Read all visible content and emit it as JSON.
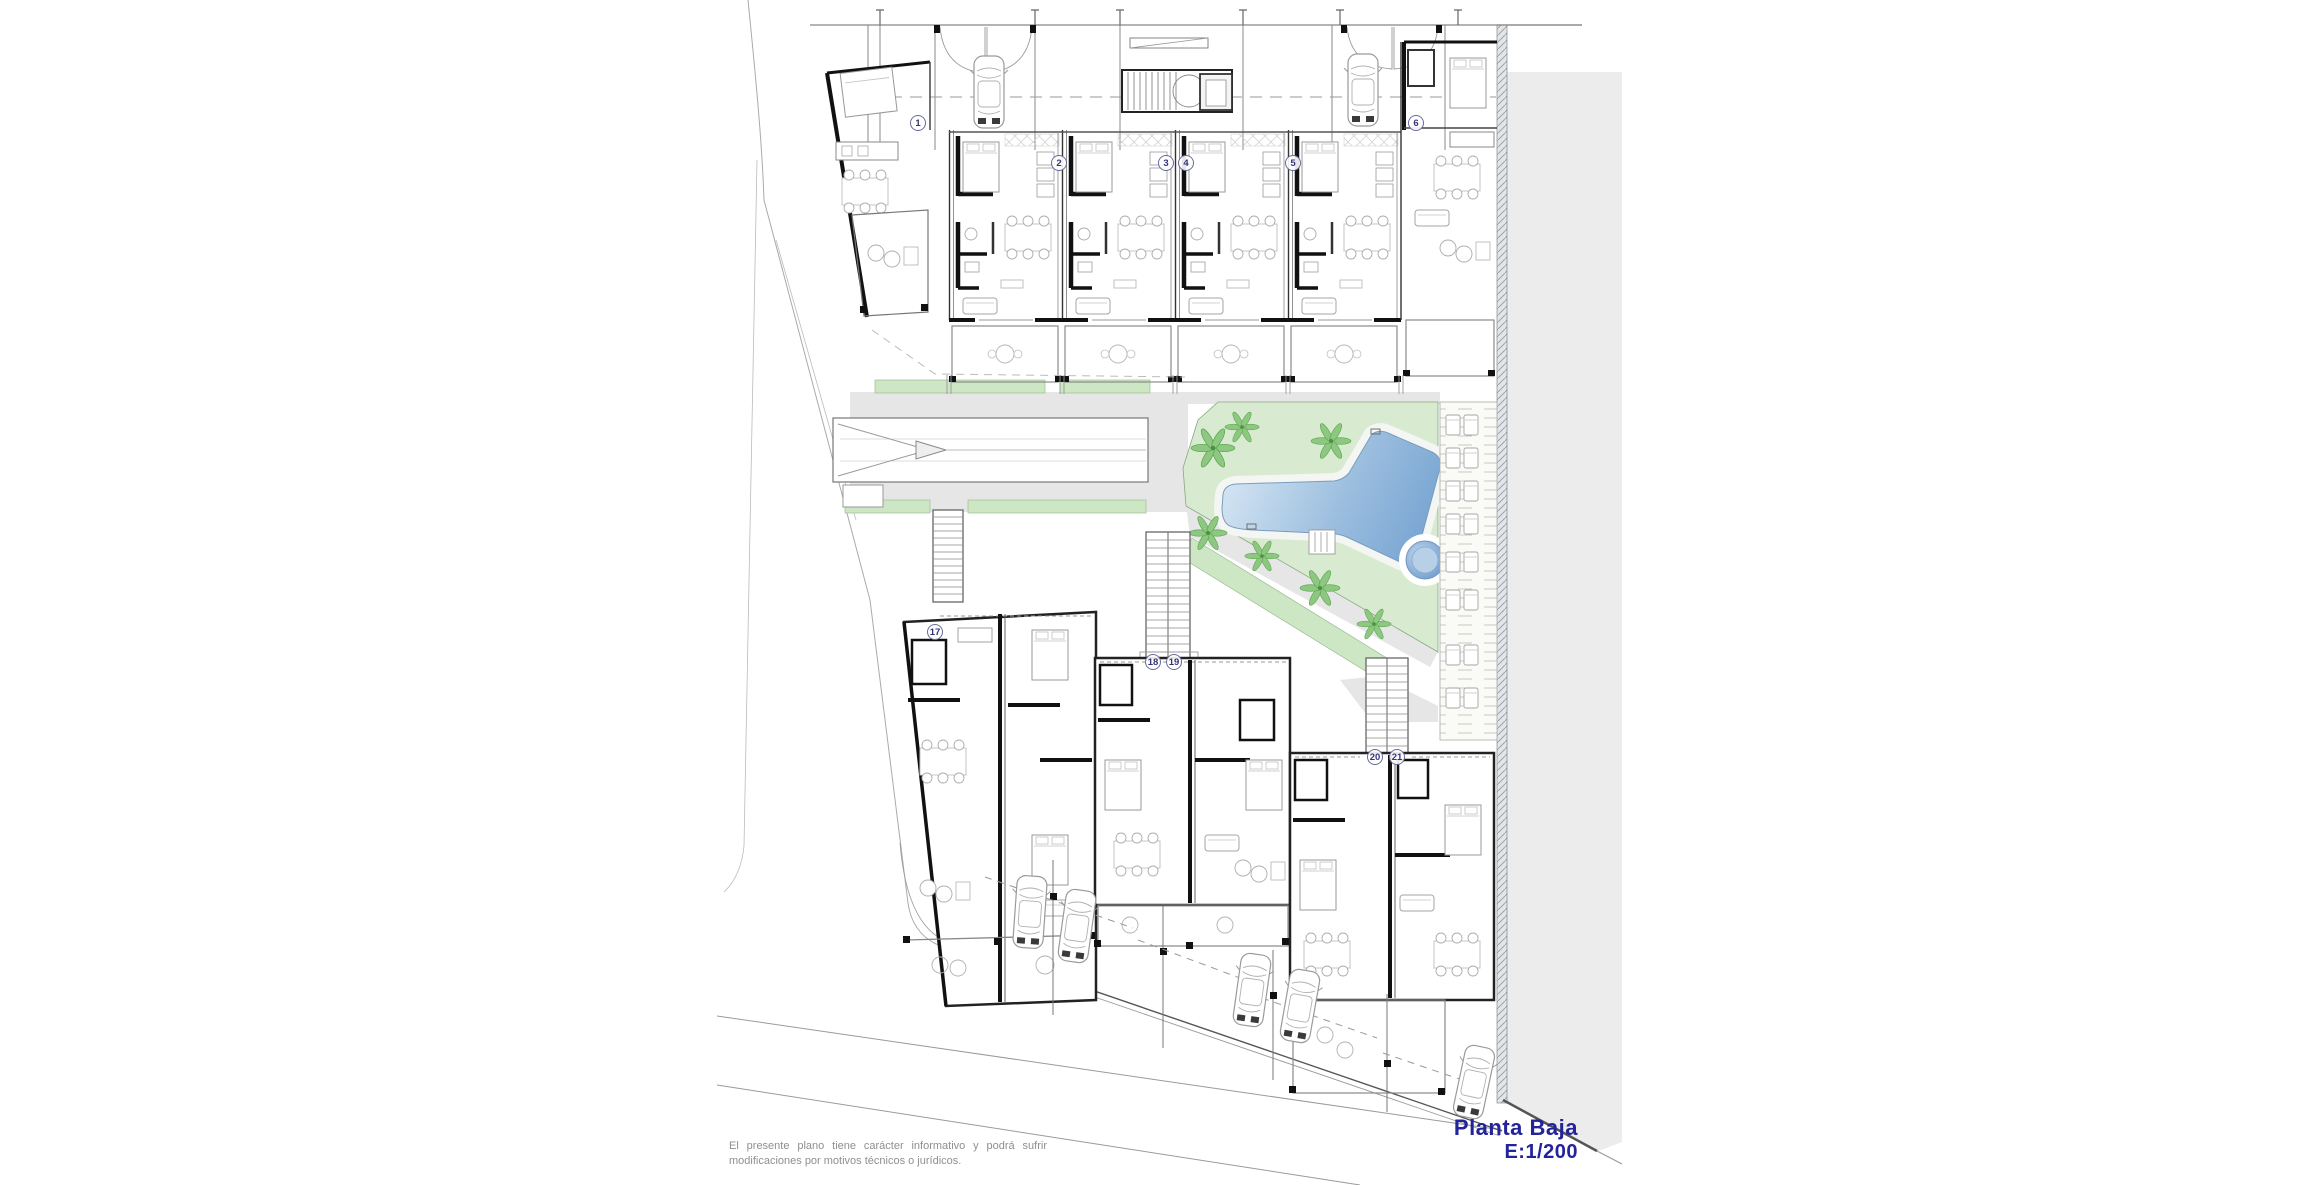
{
  "title": {
    "plan_name": "Planta Baja",
    "scale": "E:1/200"
  },
  "disclaimer": {
    "text": "El presente plano tiene carácter informativo y podrá sufrir modificaciones por motivos técnicos o jurídicos."
  },
  "unit_markers": [
    {
      "n": "1",
      "x": 918,
      "y": 123
    },
    {
      "n": "2",
      "x": 1059,
      "y": 163
    },
    {
      "n": "3",
      "x": 1166,
      "y": 163
    },
    {
      "n": "4",
      "x": 1186,
      "y": 163
    },
    {
      "n": "5",
      "x": 1293,
      "y": 163
    },
    {
      "n": "6",
      "x": 1416,
      "y": 123
    },
    {
      "n": "17",
      "x": 935,
      "y": 632
    },
    {
      "n": "18",
      "x": 1153,
      "y": 662
    },
    {
      "n": "19",
      "x": 1174,
      "y": 662
    },
    {
      "n": "20",
      "x": 1375,
      "y": 757
    },
    {
      "n": "21",
      "x": 1397,
      "y": 757
    }
  ],
  "colors": {
    "title_text": "#23239a",
    "disclaimer_text": "#8f8f8f",
    "pool_light": "#d7e7f4",
    "pool_dark": "#6f9ecf",
    "landscape_green": "#d8eacf",
    "strip_green": "#cde6c3",
    "paving_gray": "#e6e6e6",
    "wall_black": "#111111",
    "side_area_gray": "#ececec"
  }
}
